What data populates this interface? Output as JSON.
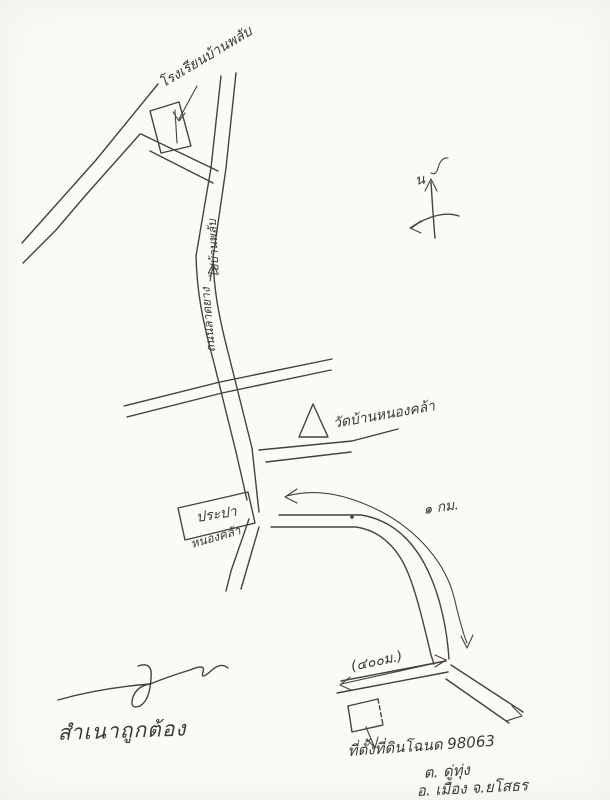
{
  "labels": {
    "school": "โรงเรียนบ้านพลับ",
    "road_dest": "ไปบ้านพลับ",
    "road_surface": "ถนนลาดยาง",
    "temple": "วัดบ้านหนองคล้า",
    "waterworks": "ประปา",
    "village": "หนองคล้า",
    "distance_km": "๑ กม.",
    "distance_m": "(๔๐๐ม.)",
    "north": "น",
    "certified": "สำเนาถูกต้อง",
    "deed_line1": "ที่ตั้งที่ดินโฉนด 98063",
    "deed_line2": "ต. ดู่ทุ่ง",
    "deed_line3": "อ. เมือง จ.ยโสธร"
  },
  "colors": {
    "ink": "#45423e",
    "paper": "#fbfaf7"
  }
}
